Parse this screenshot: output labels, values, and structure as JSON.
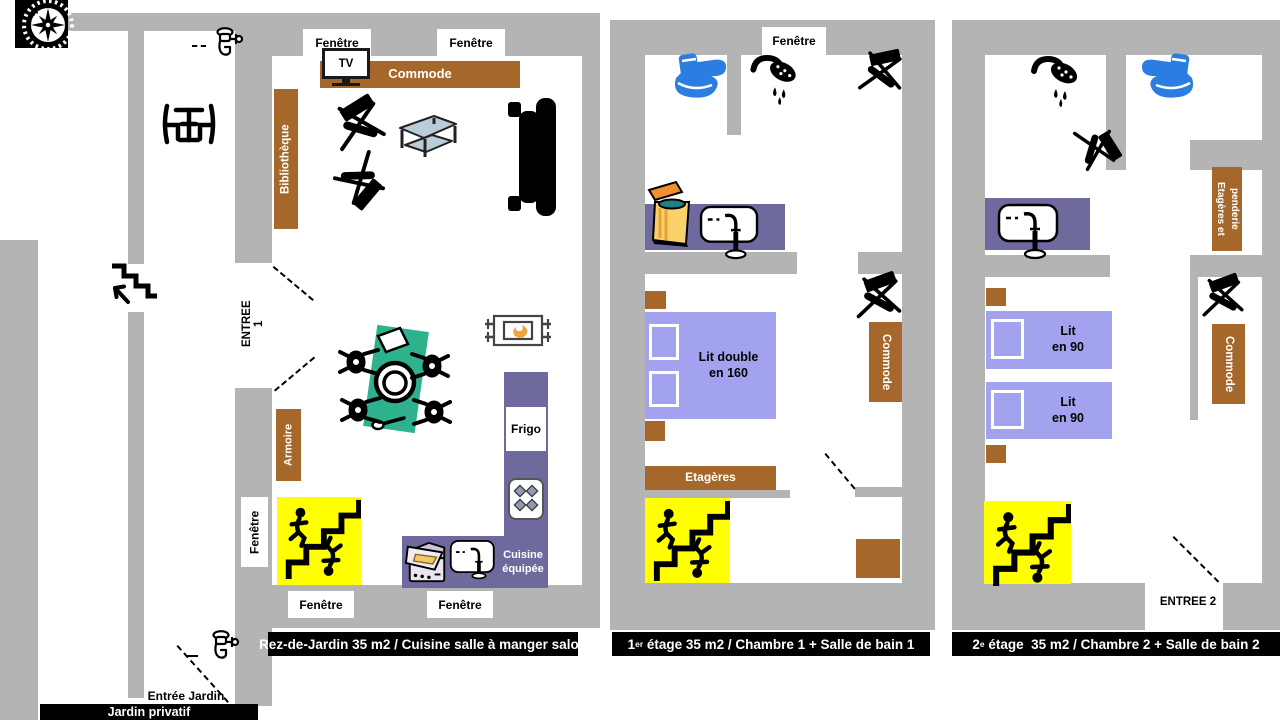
{
  "colors": {
    "wall": "#b4b4b4",
    "wood": "#a5682a",
    "counter": "#6f6a9e",
    "bed": "#a2a2ee",
    "stairs": "#ffff00",
    "tablecloth": "#2eb28d",
    "toilet": "#2b7de2",
    "banner": "#000000",
    "flame": "#f2a23c",
    "table_top": "#b9cdd9"
  },
  "floor1": {
    "banner": "Rez-de-Jardin 35 m2 / Cuisine salle à manger salon",
    "windows": {
      "top1": "Fenêtre",
      "top2": "Fenêtre",
      "left": "Fenêtre",
      "bottom1": "Fenêtre",
      "bottom2": "Fenêtre"
    },
    "tv": "TV",
    "commode": "Commode",
    "bibliotheque": "Bibliothèque",
    "entree": "ENTREE 1",
    "armoire": "Armoire",
    "frigo": "Frigo",
    "cuisine": "Cuisine\néquipée",
    "entree_jardin": "Entrée Jardin",
    "jardin": "Jardin privatif"
  },
  "floor2": {
    "window_top": "Fenêtre",
    "bed": "Lit double\nen 160",
    "commode": "Commode",
    "etageres": "Etagères",
    "banner": {
      "num": "1",
      "sup": "er",
      "rest": " étage 35 m2 / Chambre 1 + Salle de bain 1"
    }
  },
  "floor3": {
    "etageres_penderie": "Etagères et\npenderie",
    "bed1": "Lit\nen 90",
    "bed2": "Lit\nen 90",
    "commode": "Commode",
    "entree": "ENTREE 2",
    "banner": {
      "num": "2",
      "sup": "e",
      "rest": " étage  35 m2 / Chambre 2 + Salle de bain 2"
    }
  },
  "icons": {
    "compass": "compass-rose",
    "outdoor_tap": "garden-faucet",
    "garden_table": "table-with-two-chairs",
    "exterior_stairs": "stairs-with-arrow",
    "tv": "television",
    "lounge_chair": "folding-chair",
    "coffee_table": "low-table",
    "sofa": "sofa",
    "heater": "radiator-with-flame",
    "dining_table": "table-with-four-stools",
    "interior_stairs": "staircase-with-figures",
    "fridge": "refrigerator",
    "hob": "four-burner-stove",
    "oven": "oven",
    "sink": "sink-with-tap",
    "toilet": "toilet",
    "shower": "shower-head",
    "washing_machine": "top-load-washer"
  }
}
